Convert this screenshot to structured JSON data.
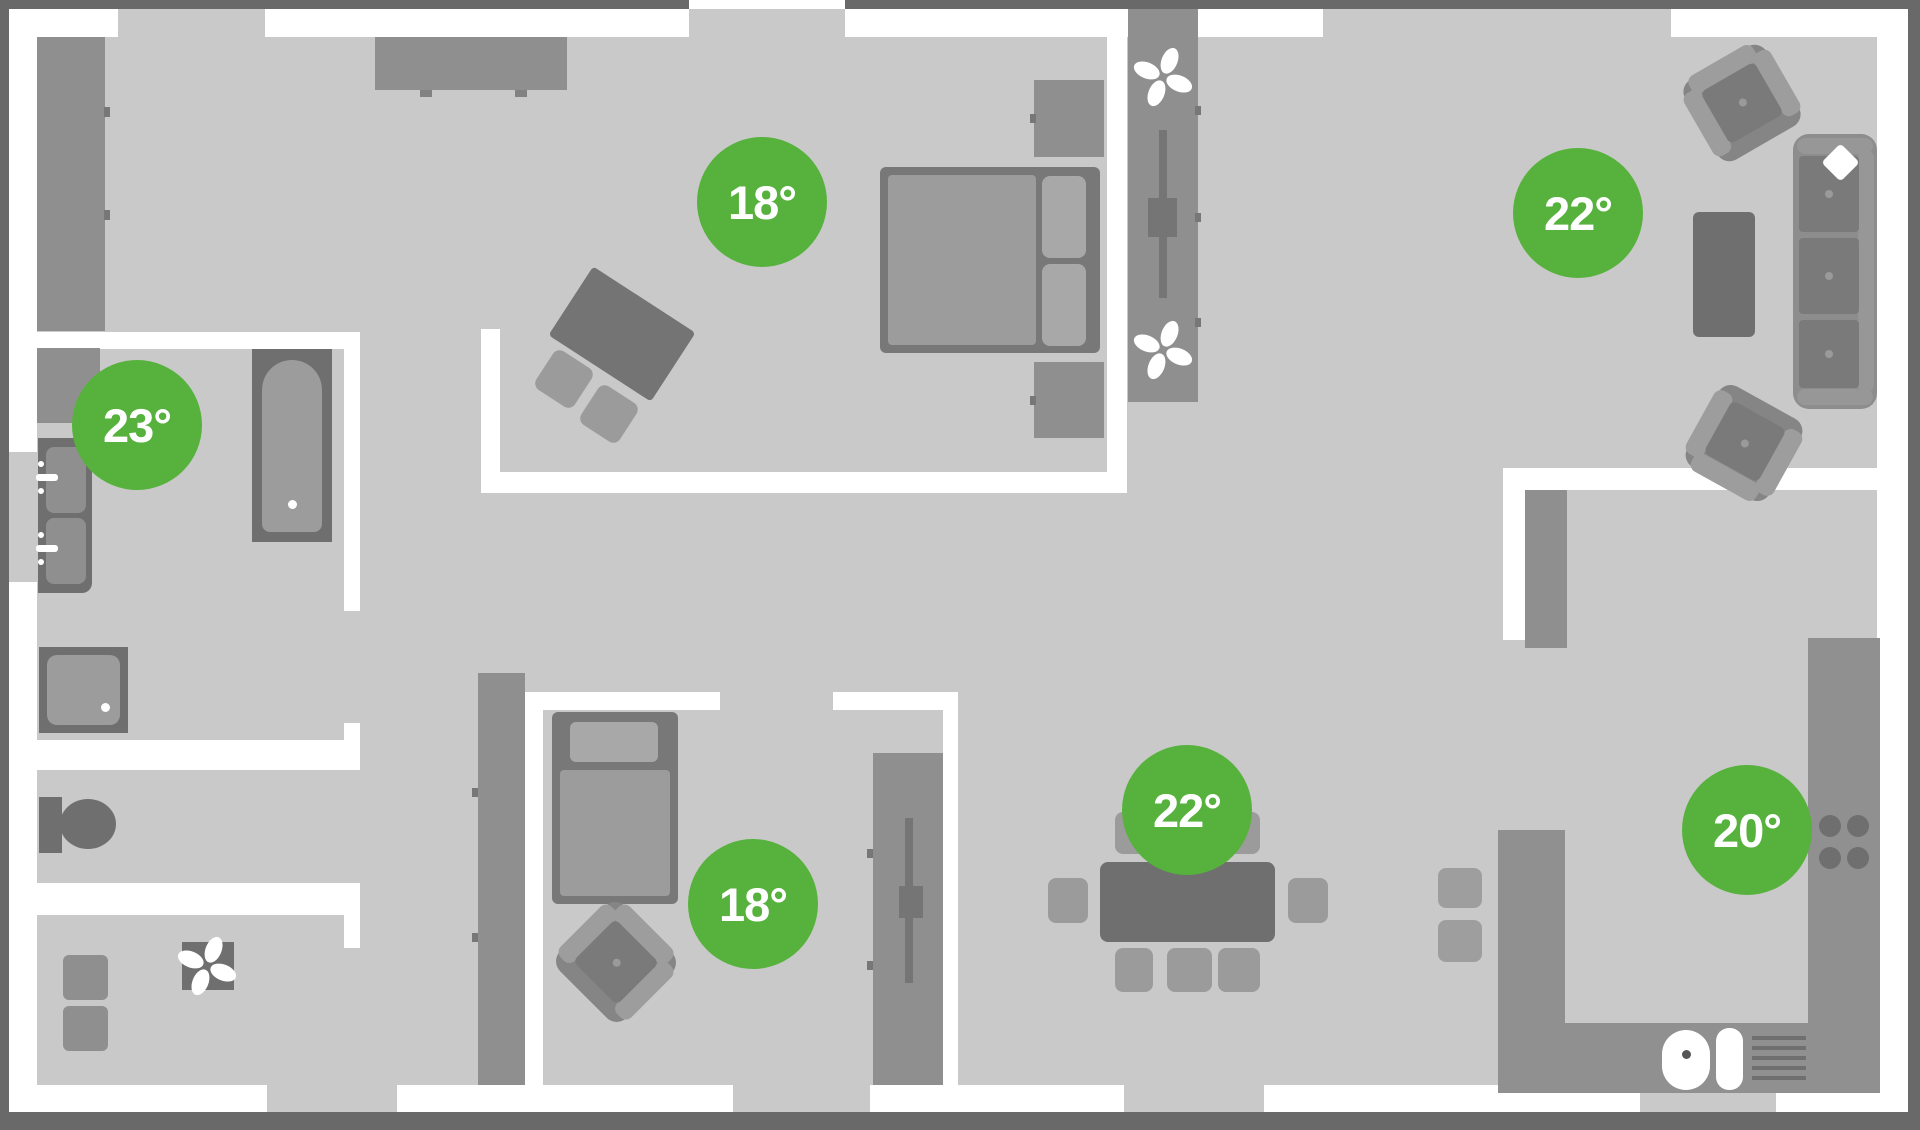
{
  "view": "floor-plan",
  "colors": {
    "accent_green": "#56b23c",
    "badge_text": "#ffffff",
    "floor": "#c9c9c9",
    "walls": "#ffffff",
    "frame": "#696969"
  },
  "rooms": [
    {
      "id": "bathroom",
      "temperature": "23°"
    },
    {
      "id": "bedroom",
      "temperature": "18°"
    },
    {
      "id": "living-room",
      "temperature": "22°"
    },
    {
      "id": "kids-bedroom",
      "temperature": "18°"
    },
    {
      "id": "dining-area",
      "temperature": "22°"
    },
    {
      "id": "kitchen",
      "temperature": "20°"
    }
  ],
  "icons": {
    "fan": "fan-icon"
  }
}
